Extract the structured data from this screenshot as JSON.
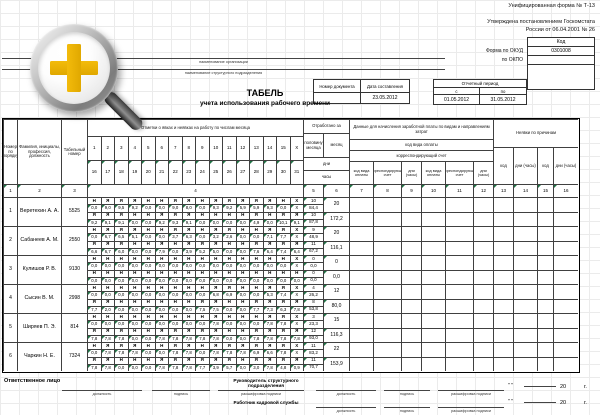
{
  "meta": {
    "form_label": "Унифицированная форма № Т-13",
    "approved1": "Утверждена постановлением Госкомстата",
    "approved2": "России от 06.04.2001 № 26",
    "code_header": "Код",
    "okud_label": "Форма по ОКУД",
    "okud_value": "0301008",
    "okpo_label": "по ОКПО",
    "org_caption": "наименование организации",
    "dept_caption": "наименование структурного подразделения"
  },
  "doc": {
    "number_label": "Номер документа",
    "date_label": "Дата составления",
    "number_value": "",
    "date_value": "23.05.2012"
  },
  "period": {
    "label": "Отчетный период",
    "from_label": "с",
    "to_label": "по",
    "from": "01.05.2012",
    "to": "31.05.2012"
  },
  "title": {
    "main": "ТАБЕЛЬ",
    "sub": "учета использования рабочего времени"
  },
  "icons": {
    "magnifier": "zoom-in-magnifier",
    "plus_color": "#EDB200"
  },
  "table": {
    "headers": {
      "num": "Номер по порядку",
      "name": "Фамилия, инициалы, профессия, должность",
      "tab_no": "Табельный номер",
      "days": "Отметки о явках и неявках на работу по числам месяца",
      "worked": "Отработано за",
      "half": "половину месяца",
      "month": "месяц",
      "days_unit": "дни",
      "hours_unit": "часы",
      "pay": "Данные для начисления заработной платы по видам и направлениям затрат",
      "pay_code": "код вида оплаты",
      "pay_account": "корреспондирующий счет",
      "pay_sub": [
        "код вида оплаты",
        "корреспондирующий счет",
        "дни (часы)",
        "код вида оплаты",
        "корреспондирующий счет",
        "дни (часы)"
      ],
      "absence": "Неявки по причинам",
      "absence_sub": [
        "код",
        "дни (часы)",
        "код",
        "дни (часы)"
      ]
    },
    "day_numbers_first": [
      "1",
      "2",
      "3",
      "4",
      "5",
      "6",
      "7",
      "8",
      "9",
      "10",
      "11",
      "12",
      "13",
      "14",
      "15",
      "Х"
    ],
    "day_numbers_second": [
      "16",
      "17",
      "18",
      "19",
      "20",
      "21",
      "22",
      "23",
      "24",
      "25",
      "26",
      "27",
      "28",
      "29",
      "30",
      "31"
    ],
    "col_numbers": [
      "1",
      "2",
      "3",
      "4",
      "5",
      "6",
      "7",
      "8",
      "9",
      "10",
      "11",
      "12",
      "13",
      "14",
      "15",
      "16"
    ],
    "rows": [
      {
        "num": "1",
        "name": "Веретехин А. А.",
        "personnel_no": "5525",
        "marks1": [
          "Н",
          "Я",
          "Я",
          "Я",
          "Н",
          "Н",
          "Я",
          "Я",
          "Н",
          "Я",
          "Я",
          "Я",
          "Я",
          "Я",
          "Н",
          "Х"
        ],
        "hours1": [
          "0,0",
          "9,0",
          "9,5",
          "9,2",
          "0,0",
          "0,0",
          "9,0",
          "8,0",
          "0,0",
          "9,3",
          "9,2",
          "5,9",
          "5,9",
          "9,3",
          "0,0",
          "Х"
        ],
        "marks2": [
          "Я",
          "Я",
          "Я",
          "Н",
          "Н",
          "Я",
          "Я",
          "Я",
          "Н",
          "Н",
          "Н",
          "Н",
          "Я",
          "Н",
          "Я",
          "Я"
        ],
        "hours2": [
          "9,2",
          "9,1",
          "9,1",
          "0,0",
          "0,0",
          "9,2",
          "9,3",
          "9,1",
          "0,0",
          "0,0",
          "0,0",
          "0,0",
          "4,9",
          "0,0",
          "10,1",
          "9,1"
        ],
        "half1_days": "10",
        "half1_hours": "84,4",
        "half2_days": "10",
        "half2_hours": "87,8",
        "month_days": "20",
        "month_hours": "172,2"
      },
      {
        "num": "2",
        "name": "Сабанеев А. М.",
        "personnel_no": "2550",
        "marks1": [
          "Н",
          "Я",
          "Я",
          "Я",
          "Н",
          "Н",
          "Я",
          "Я",
          "Н",
          "Я",
          "Я",
          "Н",
          "Н",
          "Я",
          "Я",
          "Х"
        ],
        "hours1": [
          "0,0",
          "6,7",
          "6,5",
          "5,1",
          "0,0",
          "0,0",
          "3,7",
          "6,3",
          "0,0",
          "3,2",
          "2,6",
          "0,0",
          "0,0",
          "7,1",
          "7,7",
          "Х"
        ],
        "marks2": [
          "Я",
          "Я",
          "Я",
          "Н",
          "Н",
          "Я",
          "Н",
          "Я",
          "Я",
          "Я",
          "Н",
          "Н",
          "Я",
          "Я",
          "Я",
          "Я"
        ],
        "hours2": [
          "6,6",
          "6,7",
          "6,0",
          "0,0",
          "0,0",
          "7,9",
          "0,0",
          "3,9",
          "5,2",
          "5,0",
          "0,0",
          "0,0",
          "7,6",
          "6,4",
          "7,4",
          "6,4"
        ],
        "half1_days": "9",
        "half1_hours": "48,9",
        "half2_days": "11",
        "half2_hours": "67,2",
        "month_days": "20",
        "month_hours": "116,1"
      },
      {
        "num": "3",
        "name": "Кулишов Р. В.",
        "personnel_no": "9130",
        "marks1": [
          "Н",
          "Н",
          "Н",
          "Н",
          "Н",
          "Н",
          "Н",
          "Н",
          "Н",
          "Н",
          "Н",
          "Н",
          "Н",
          "Н",
          "Н",
          "Х"
        ],
        "hours1": [
          "0,0",
          "0,0",
          "0,0",
          "0,0",
          "0,0",
          "0,0",
          "0,0",
          "0,0",
          "0,0",
          "0,0",
          "0,0",
          "0,0",
          "0,0",
          "0,0",
          "0,0",
          "Х"
        ],
        "marks2": [
          "Н",
          "Н",
          "Н",
          "Н",
          "Н",
          "Н",
          "Н",
          "Н",
          "Н",
          "Н",
          "Н",
          "Н",
          "Н",
          "Н",
          "Н",
          "Н"
        ],
        "hours2": [
          "0,0",
          "0,0",
          "0,0",
          "0,0",
          "0,0",
          "0,0",
          "0,0",
          "0,0",
          "0,0",
          "0,0",
          "0,0",
          "0,0",
          "0,0",
          "0,0",
          "0,0",
          "0,0"
        ],
        "half1_days": "0",
        "half1_hours": "0,0",
        "half2_days": "0",
        "half2_hours": "0,0",
        "month_days": "0",
        "month_hours": "0,0"
      },
      {
        "num": "4",
        "name": "Сысин В. М.",
        "personnel_no": "2998",
        "marks1": [
          "Н",
          "Н",
          "Н",
          "Н",
          "Н",
          "Н",
          "Н",
          "Н",
          "Н",
          "Я",
          "Я",
          "Н",
          "Н",
          "Я",
          "Я",
          "Х"
        ],
        "hours1": [
          "0,0",
          "0,0",
          "0,0",
          "0,0",
          "0,0",
          "0,0",
          "0,0",
          "0,0",
          "0,0",
          "6,8",
          "6,9",
          "0,0",
          "0,0",
          "5,3",
          "7,4",
          "Х"
        ],
        "marks2": [
          "Я",
          "Я",
          "Н",
          "Н",
          "Н",
          "Н",
          "Н",
          "Н",
          "Я",
          "Я",
          "Н",
          "Н",
          "Я",
          "Я",
          "Я",
          "Я"
        ],
        "hours2": [
          "7,7",
          "2,0",
          "0,0",
          "0,0",
          "0,0",
          "0,0",
          "0,0",
          "0,0",
          "7,5",
          "7,5",
          "0,0",
          "0,0",
          "7,7",
          "7,3",
          "6,3",
          "7,8"
        ],
        "half1_days": "4",
        "half1_hours": "26,2",
        "half2_days": "8",
        "half2_hours": "53,8",
        "month_days": "12",
        "month_hours": "80,0"
      },
      {
        "num": "5",
        "name": "Ширяев П. Э.",
        "personnel_no": "814",
        "marks1": [
          "Н",
          "Н",
          "Н",
          "Н",
          "Н",
          "Н",
          "Н",
          "Н",
          "Н",
          "Я",
          "Н",
          "Н",
          "Н",
          "Я",
          "Я",
          "Х"
        ],
        "hours1": [
          "0,0",
          "0,0",
          "0,0",
          "0,0",
          "0,0",
          "0,0",
          "0,0",
          "0,0",
          "0,0",
          "7,8",
          "0,0",
          "0,0",
          "0,0",
          "7,8",
          "7,8",
          "Х"
        ],
        "marks2": [
          "Я",
          "Я",
          "Я",
          "Н",
          "Н",
          "Я",
          "Я",
          "Я",
          "Я",
          "Я",
          "Н",
          "Н",
          "Я",
          "Я",
          "Я",
          "Я"
        ],
        "hours2": [
          "7,8",
          "7,8",
          "7,8",
          "0,0",
          "0,0",
          "7,8",
          "7,8",
          "7,8",
          "7,8",
          "7,8",
          "0,0",
          "0,0",
          "7,8",
          "7,8",
          "7,8",
          "7,8"
        ],
        "half1_days": "3",
        "half1_hours": "23,3",
        "half2_days": "12",
        "half2_hours": "93,0",
        "month_days": "15",
        "month_hours": "116,3"
      },
      {
        "num": "6",
        "name": "Чаркин Н. Е.",
        "personnel_no": "7324",
        "marks1": [
          "Н",
          "Я",
          "Я",
          "Я",
          "Н",
          "Н",
          "Я",
          "Я",
          "Н",
          "Я",
          "Я",
          "Я",
          "Я",
          "Я",
          "Я",
          "Х"
        ],
        "hours1": [
          "0,0",
          "7,8",
          "7,8",
          "7,8",
          "0,0",
          "0,0",
          "7,8",
          "7,8",
          "0,0",
          "7,8",
          "7,8",
          "7,8",
          "6,9",
          "6,6",
          "7,8",
          "Х"
        ],
        "marks2": [
          "Я",
          "Я",
          "Н",
          "Н",
          "Н",
          "Я",
          "Я",
          "Я",
          "Я",
          "Я",
          "Я",
          "Н",
          "Я",
          "Я",
          "Я",
          "Я"
        ],
        "hours2": [
          "7,8",
          "7,8",
          "0,0",
          "0,0",
          "0,0",
          "7,8",
          "7,8",
          "7,8",
          "7,7",
          "3,9",
          "5,7",
          "0,0",
          "3,0",
          "7,8",
          "4,8",
          "0,9"
        ],
        "half1_days": "11",
        "half1_hours": "83,2",
        "half2_days": "11",
        "half2_hours": "70,7",
        "month_days": "22",
        "month_hours": "153,9"
      }
    ]
  },
  "footer": {
    "responsible": "Ответственное лицо",
    "position_label": "должность",
    "signature_label": "подпись",
    "transcript_label": "расшифровка подписи",
    "head_title": "Руководитель структурного подразделения",
    "hr_title": "Работник кадровой службы",
    "quotes": "\"      \"",
    "year": "20",
    "year_g": "г."
  }
}
